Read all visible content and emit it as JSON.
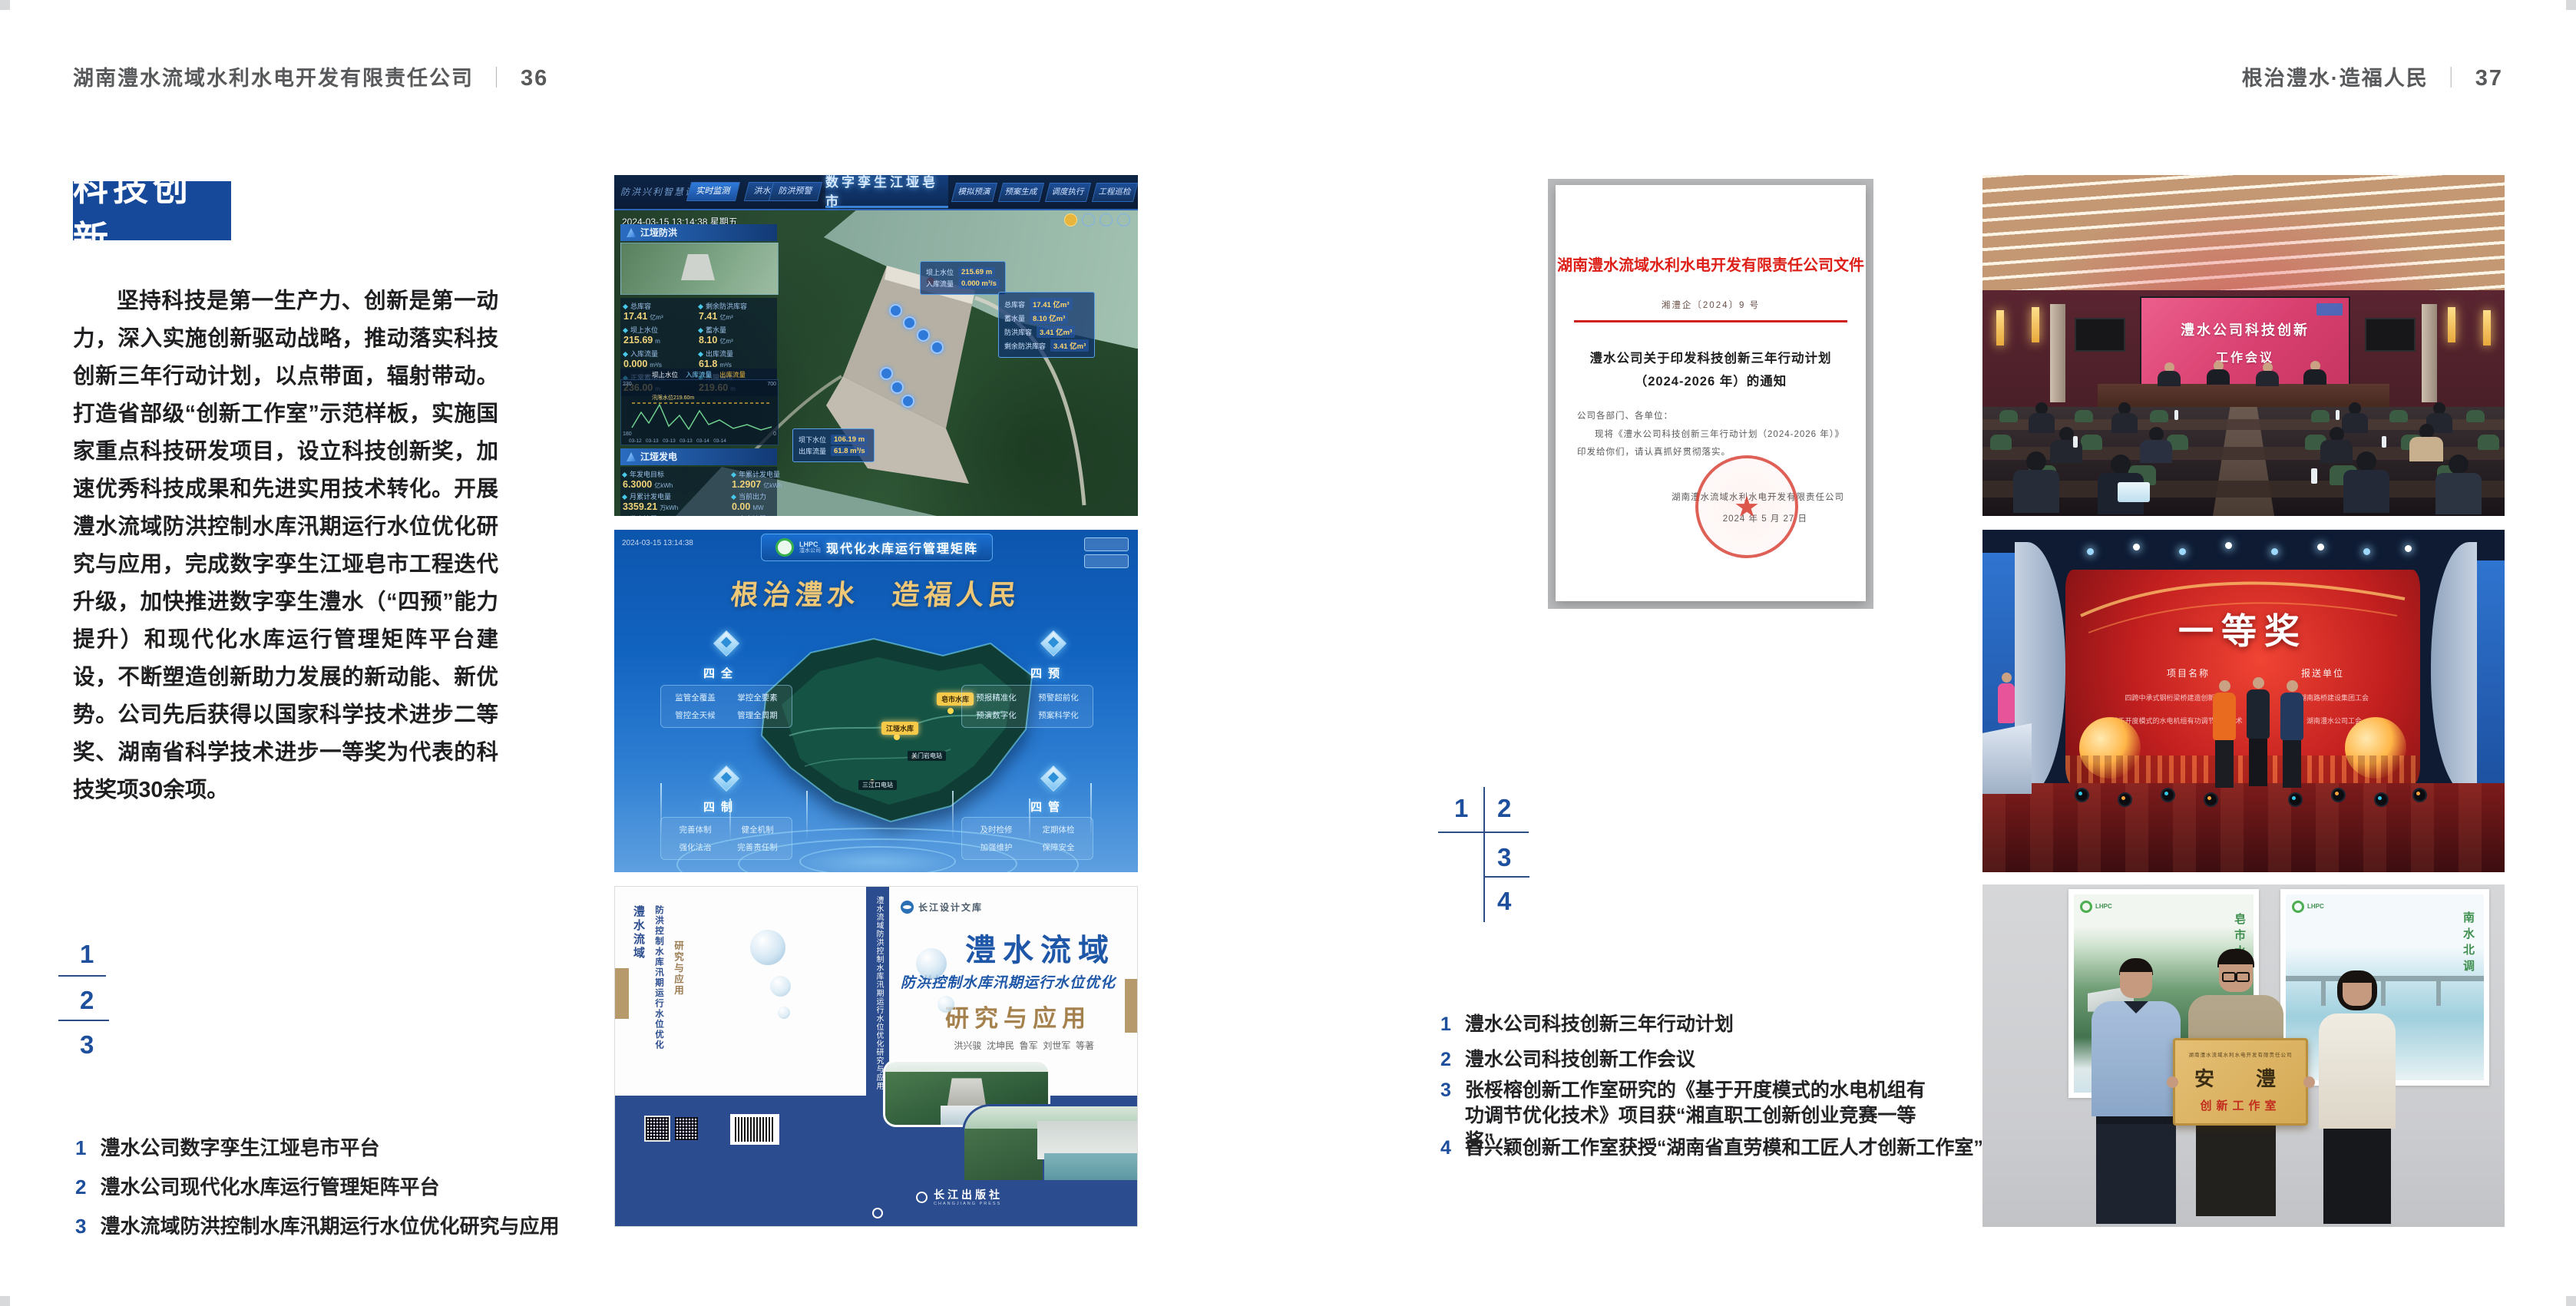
{
  "colors": {
    "accent_blue": "#17499b",
    "header_gray": "#58595b",
    "doc_red": "#dd1f17",
    "band_blue": "#2b4d8f"
  },
  "header_left": {
    "company": "湖南澧水流域水利水电开发有限责任公司",
    "divider": "｜",
    "page": "36"
  },
  "header_right": {
    "slogan": "根治澧水·造福人民",
    "divider": "｜",
    "page": "37"
  },
  "section": {
    "badge": "科技创新",
    "paragraph": "坚持科技是第一生产力、创新是第一动力，深入实施创新驱动战略，推动落实科技创新三年行动计划，以点带面，辐射带动。打造省部级“创新工作室”示范样板，实施国家重点科技研发项目，设立科技创新奖，加速优秀科技成果和先进实用技术转化。开展澧水流域防洪控制水库汛期运行水位优化研究与应用，完成数字孪生江垭皂市工程迭代升级，加快推进数字孪生澧水（“四预”能力提升）和现代化水库运行管理矩阵平台建设，不断塑造创新助力发展的新动能、新优势。公司先后获得以国家科学技术进步二等奖、湖南省科学技术进步一等奖为代表的科技奖项30余项。"
  },
  "left_markers": {
    "m1": "1",
    "m2": "2",
    "m3": "3"
  },
  "left_captions": {
    "items": [
      {
        "no": "1",
        "text": "澧水公司数字孪生江垭皂市平台"
      },
      {
        "no": "2",
        "text": "澧水公司现代化水库运行管理矩阵平台"
      },
      {
        "no": "3",
        "text": "澧水流域防洪控制水库汛期运行水位优化研究与应用"
      }
    ]
  },
  "right_markers": {
    "m1": "1",
    "m2": "2",
    "m3": "3",
    "m4": "4"
  },
  "right_captions": {
    "items": [
      {
        "no": "1",
        "text": "澧水公司科技创新三年行动计划"
      },
      {
        "no": "2",
        "text": "澧水公司科技创新工作会议"
      },
      {
        "no": "3",
        "text": "张桵榕创新工作室研究的《基于开度模式的水电机组有功调节优化技术》项目获“湘直职工创新创业竞赛一等奖”"
      },
      {
        "no": "4",
        "text": "曾兴颖创新工作室获授“湖南省直劳模和工匠人才创新工作室”"
      }
    ]
  },
  "fig_twin": {
    "corner_label": "防洪兴利智慧调度",
    "title": "数字孪生江垭皂市",
    "tabs_left": [
      "实时监测",
      "洪水预报",
      "防洪预警"
    ],
    "tabs_right": [
      "模拟预演",
      "预案生成",
      "调度执行",
      "工程巡检"
    ],
    "datetime": "2024-03-15 13:14:38 星期五",
    "panel1": {
      "title": "江垭防洪",
      "stats": [
        {
          "l": "总库容",
          "v": "17.41",
          "u": "亿m³"
        },
        {
          "l": "剩余防洪库容",
          "v": "7.41",
          "u": "亿m³"
        },
        {
          "l": "坝上水位",
          "v": "215.69",
          "u": "m"
        },
        {
          "l": "蓄水量",
          "v": "8.10",
          "u": "亿m³"
        },
        {
          "l": "入库流量",
          "v": "0.000",
          "u": "m³/s"
        },
        {
          "l": "出库流量",
          "v": "61.8",
          "u": "m³/s"
        },
        {
          "l": "正常蓄水位",
          "v": "236.00",
          "u": "m"
        },
        {
          "l": "汛限水位",
          "v": "219.60",
          "u": "m"
        }
      ],
      "legend": [
        "坝上水位",
        "入库流量",
        "出库流量"
      ],
      "chart_note": "汛限水位219.60m",
      "y_left_top": "230",
      "y_left_bottom": "180",
      "y_right_top": "700",
      "y_right_bottom": "0",
      "x_ticks": "03-12   03-13   03-13   03-13   03-14   03-14"
    },
    "panel2": {
      "title": "江垭发电",
      "stats": [
        {
          "l": "年发电目标",
          "v": "6.3000",
          "u": "亿kWh"
        },
        {
          "l": "年累计发电量",
          "v": "1.2907",
          "u": "亿kWh"
        },
        {
          "l": "月累计发电量",
          "v": "3359.21",
          "u": "万kWh"
        },
        {
          "l": "当前出力",
          "v": "0.00",
          "u": "MW"
        },
        {
          "l": "发电流量",
          "v": "0.00",
          "u": "m³/s"
        },
        {
          "l": "弃水流量",
          "v": "0.00",
          "u": "m³/s"
        }
      ],
      "gauges": [
        "0.00",
        "102.98",
        "0.00"
      ]
    },
    "tooltip_top": {
      "rows": [
        {
          "l": "坝上水位",
          "v": "215.69 m"
        },
        {
          "l": "入库流量",
          "v": "0.000 m³/s"
        }
      ]
    },
    "tooltip_right": {
      "rows": [
        {
          "l": "总库容",
          "v": "17.41 亿m³"
        },
        {
          "l": "蓄水量",
          "v": "8.10 亿m³"
        },
        {
          "l": "防洪库容",
          "v": "3.41 亿m³"
        },
        {
          "l": "剩余防洪库容",
          "v": "3.41 亿m³"
        }
      ]
    },
    "tooltip_bottom": {
      "rows": [
        {
          "l": "坝下水位",
          "v": "106.19 m"
        },
        {
          "l": "出库流量",
          "v": "61.8 m³/s"
        }
      ]
    }
  },
  "fig_matrix": {
    "logo_abbr": "LHPC",
    "logo_sub": "澧水公司",
    "title": "现代化水库运行管理矩阵",
    "datetime": "2024-03-15 13:14:38",
    "slogan": "根治澧水　造福人民",
    "panels": [
      {
        "title": "四全",
        "items": [
          "监管全覆盖",
          "掌控全要素",
          "管控全天候",
          "管理全周期"
        ]
      },
      {
        "title": "四预",
        "items": [
          "预报精准化",
          "预警超前化",
          "预演数字化",
          "预案科学化"
        ]
      },
      {
        "title": "四制",
        "items": [
          "完善体制",
          "健全机制",
          "强化法治",
          "完善责任制"
        ]
      },
      {
        "title": "四管",
        "items": [
          "及时检修",
          "定期体检",
          "加强维护",
          "保障安全"
        ]
      }
    ],
    "map_markers": {
      "m1": "皂市水库",
      "m2": "江垭水库",
      "m3": "关门岩电站",
      "m4": "三江口电站"
    }
  },
  "fig_book": {
    "series": "长江设计文库",
    "title": "澧水流域",
    "subtitle": "防洪控制水库汛期运行水位优化",
    "title2": "研究与应用",
    "authors": "洪兴骏  沈坤民  鲁军  刘世军  等著",
    "spine_text": "澧水流域防洪控制水库汛期运行水位优化研究与应用",
    "back_title1": "澧水流域",
    "back_title2": "防洪控制水库汛期运行水位优化",
    "back_title3": "研究与应用",
    "publisher": "长江出版社",
    "publisher_latin": "CHANGJIANG PRESS"
  },
  "fig_doc": {
    "letterhead": "湖南澧水流域水利水电开发有限责任公司文件",
    "doc_no": "湘澧企〔2024〕9 号",
    "title1": "澧水公司关于印发科技创新三年行动计划",
    "title2": "（2024-2026 年）的通知",
    "salutation": "公司各部门、各单位：",
    "body": "现将《澧水公司科技创新三年行动计划（2024-2026 年）》印发给你们，请认真抓好贯彻落实。",
    "signer": "湖南澧水流域水利水电开发有限责任公司",
    "date": "2024 年 5 月 27 日",
    "seal_star": "★"
  },
  "fig_meeting": {
    "screen_line1": "澧水公司科技创新",
    "screen_line2": "工作会议"
  },
  "fig_stage": {
    "award": "一等奖",
    "col1_header": "项目名称",
    "col2_header": "报送单位",
    "col1_items": [
      "四跨中承式钢桁梁桥建造创新技术",
      "基于开度模式的水电机组有功调节优化技术"
    ],
    "col2_items": [
      "湖南路桥建设集团工会",
      "湖南澧水公司工会"
    ]
  },
  "fig_plaque": {
    "org_line": "湖南澧水流域水利水电开发有限责任公司",
    "calligraphy": "安　澧",
    "label": "创新工作室",
    "poster_left_vertical": "皂市水库",
    "poster_right_vertical": "南水北调",
    "poster_logo": "LHPC"
  }
}
